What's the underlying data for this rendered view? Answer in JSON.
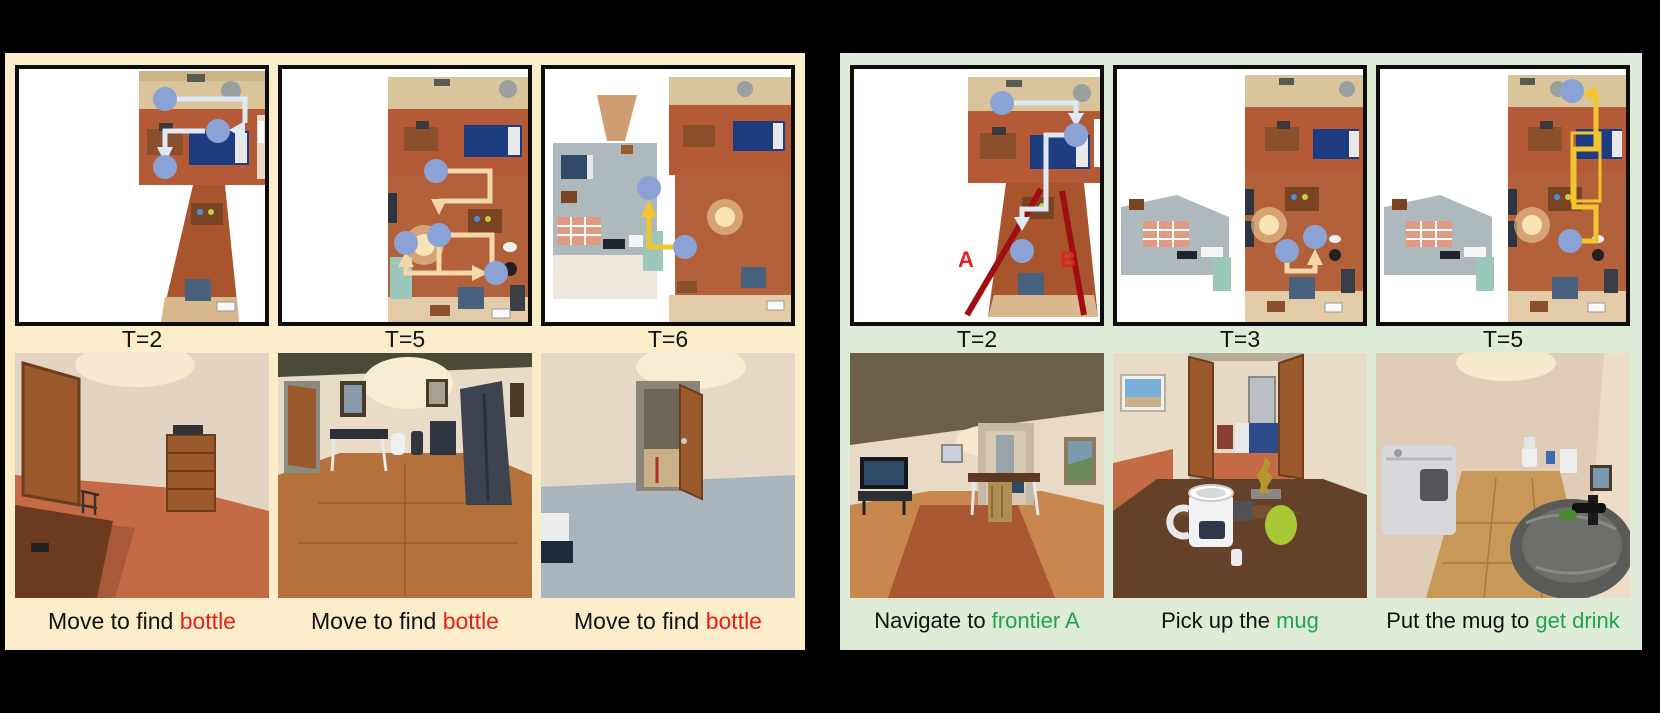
{
  "figure": {
    "left_panel_bg": "#fcedca",
    "right_panel_bg": "#deecd7",
    "canvas_bg": "#000000"
  },
  "left_panel": {
    "columns": [
      {
        "time_label": "T=2",
        "caption_prefix": "Move to find ",
        "caption_highlight": "bottle",
        "highlight_color": "#e8201a"
      },
      {
        "time_label": "T=5",
        "caption_prefix": "Move to find ",
        "caption_highlight": "bottle",
        "highlight_color": "#e8201a"
      },
      {
        "time_label": "T=6",
        "caption_prefix": "Move to find ",
        "caption_highlight": "bottle",
        "highlight_color": "#e8201a"
      }
    ]
  },
  "right_panel": {
    "columns": [
      {
        "time_label": "T=2",
        "caption_prefix": "Navigate to ",
        "caption_highlight": "frontier A",
        "highlight_color": "#21a44d"
      },
      {
        "time_label": "T=3",
        "caption_prefix": "Pick up the ",
        "caption_highlight": "mug",
        "highlight_color": "#21a44d"
      },
      {
        "time_label": "T=5",
        "caption_prefix": "Put the mug to ",
        "caption_highlight": "get drink",
        "highlight_color": "#21a44d"
      }
    ],
    "frontier_labels": {
      "a": "A",
      "b": "B"
    }
  },
  "map_symbols": {
    "agent_marker": "blue-dot",
    "agent_color": "#8ba3d4",
    "path_color_step_t2": "#dfe9f6",
    "path_color_step_t5": "#f3d7ab",
    "path_color_step_t6": "#f2c431",
    "frontier_line_color": "#9e0e12",
    "frontier_label_color": "#de2420",
    "target_highlight_box_color": "#f2c431"
  }
}
